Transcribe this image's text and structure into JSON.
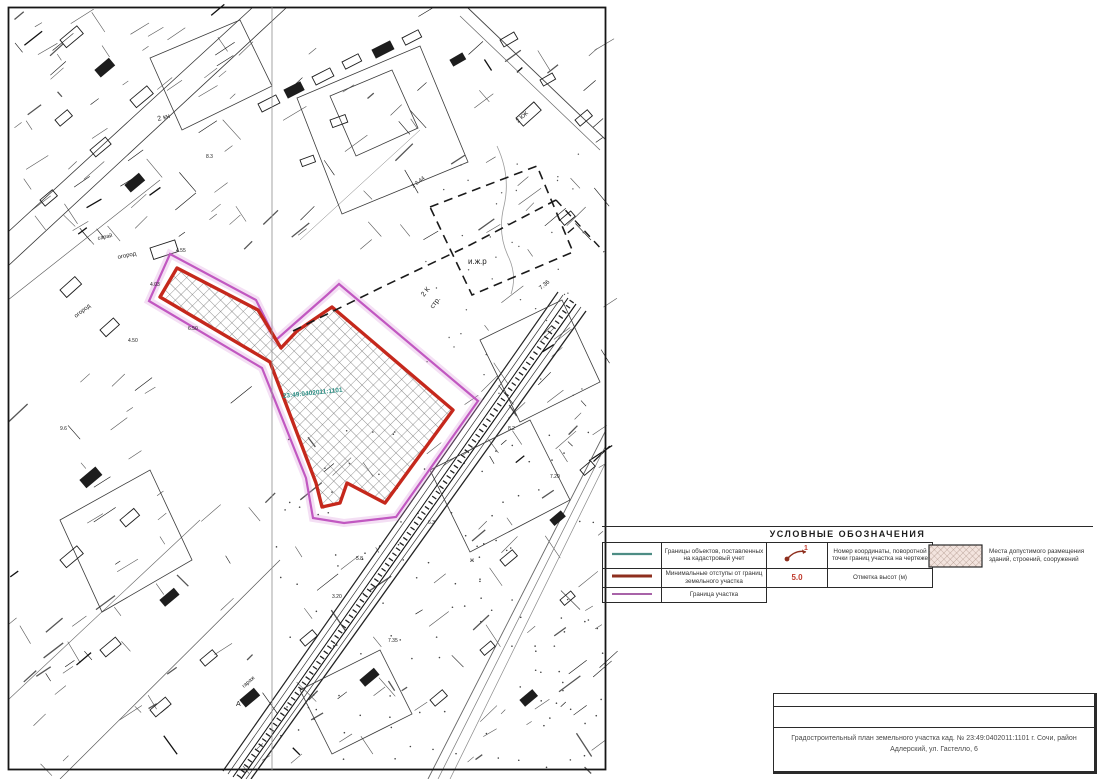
{
  "legend": {
    "title": "УСЛОВНЫЕ ОБОЗНАЧЕНИЯ",
    "rows": [
      {
        "name": "cadastre-boundary-line",
        "color": "#4d8d84",
        "sw": "2.2",
        "label": "Границы объектов, поставленных на кадастровый учет"
      },
      {
        "name": "min-setback-line",
        "color": "#8e2f1e",
        "sw": "3",
        "label": "Минимальные отступы от границ земельного участка"
      },
      {
        "name": "parcel-boundary-line",
        "color": "#a863a8",
        "sw": "2",
        "label": "Граница участка"
      }
    ],
    "symbol_rows": [
      {
        "symbol_text": "1",
        "label": "Номер координаты, поворотной точки границ участка на чертеже"
      },
      {
        "symbol_text": "5.0",
        "label": "Отметка высот (м)"
      }
    ],
    "hatch_item": {
      "label": "Места допустимого размещения зданий, строений, сооружений"
    }
  },
  "title_block": {
    "line1": "Градостроительный план земельного участка кад. № 23:49:0402011:1101 г. Сочи, район",
    "line2": "Адлерский, ул. Гастелло, 6"
  },
  "map": {
    "colors": {
      "red": "#c5281c",
      "magenta": "#c158c1",
      "hatch": "#6a6a6a",
      "teal": "#2e9086"
    },
    "red_polygon_points": "177,268 258,310 281,348 297,331 332,307 453,410 385,503 347,483 340,503 322,507 316,483 270,362 160,297",
    "magenta_polygon_points": "170,254 256,300 276,340 294,324 327,295 339,284 478,401 396,517 344,523 313,518 306,478 262,368 149,301",
    "dashed_parcel_points": "430,207 537,166 573,252 472,295",
    "dashed_line_points": "293,331 380,288 470,245 556,200",
    "dashed_line2_points": "556,200 604,252",
    "stream_d": "M497,146 q14,30 7,60 q-7,28 5,52 q8,18 2,36",
    "cadastral_label": {
      "text": "23:49:0402011:1101",
      "x": 283,
      "y": 398,
      "rot": -6,
      "size": 6.5
    },
    "labels": [
      {
        "t": "2 кн",
        "x": 158,
        "y": 121,
        "r": -15,
        "s": 7
      },
      {
        "t": "8.3",
        "x": 206,
        "y": 158,
        "r": 0,
        "s": 5
      },
      {
        "t": "сарай",
        "x": 98,
        "y": 240,
        "r": -12,
        "s": 5.5
      },
      {
        "t": "огород",
        "x": 118,
        "y": 259,
        "r": -12,
        "s": 6
      },
      {
        "t": "огород",
        "x": 76,
        "y": 318,
        "r": -38,
        "s": 6
      },
      {
        "t": "4.03",
        "x": 150,
        "y": 286,
        "r": 0,
        "s": 5
      },
      {
        "t": "4.55",
        "x": 176,
        "y": 252,
        "r": 0,
        "s": 5
      },
      {
        "t": "4.50",
        "x": 128,
        "y": 342,
        "r": 0,
        "s": 5
      },
      {
        "t": "6.50",
        "x": 188,
        "y": 330,
        "r": 0,
        "s": 5
      },
      {
        "t": "и.ж.р",
        "x": 468,
        "y": 264,
        "r": 0,
        "s": 8
      },
      {
        "t": "2 К",
        "x": 424,
        "y": 297,
        "r": -52,
        "s": 7
      },
      {
        "t": "стр.",
        "x": 433,
        "y": 309,
        "r": -52,
        "s": 7
      },
      {
        "t": "7.36",
        "x": 541,
        "y": 290,
        "r": -40,
        "s": 6
      },
      {
        "t": "1 2.44",
        "x": 413,
        "y": 188,
        "r": -38,
        "s": 5.5
      },
      {
        "t": "2 КЖ",
        "x": 518,
        "y": 123,
        "r": -42,
        "s": 6
      },
      {
        "t": "7.35",
        "x": 388,
        "y": 642,
        "r": 0,
        "s": 5
      },
      {
        "t": "гараж",
        "x": 244,
        "y": 688,
        "r": -42,
        "s": 5.5
      },
      {
        "t": "3.20",
        "x": 332,
        "y": 598,
        "r": 0,
        "s": 5
      },
      {
        "t": "6.3",
        "x": 428,
        "y": 524,
        "r": 0,
        "s": 5
      },
      {
        "t": "7.20",
        "x": 550,
        "y": 478,
        "r": 0,
        "s": 5
      },
      {
        "t": "5.8",
        "x": 356,
        "y": 560,
        "r": 0,
        "s": 5
      },
      {
        "t": "ж",
        "x": 470,
        "y": 562,
        "r": 0,
        "s": 6
      },
      {
        "t": "А",
        "x": 236,
        "y": 706,
        "r": 0,
        "s": 7
      },
      {
        "t": "8.2",
        "x": 508,
        "y": 430,
        "r": 0,
        "s": 5
      },
      {
        "t": "9.6",
        "x": 60,
        "y": 430,
        "r": 0,
        "s": 5
      }
    ],
    "roads": [
      {
        "x1": 558,
        "y1": 292,
        "x2": 223,
        "y2": 771,
        "w": 1.2,
        "c": "#222"
      },
      {
        "x1": 563,
        "y1": 295,
        "x2": 228,
        "y2": 774,
        "w": 0.7,
        "c": "#333"
      },
      {
        "x1": 568,
        "y1": 298,
        "x2": 233,
        "y2": 777,
        "w": 1,
        "c": "#111"
      },
      {
        "x1": 572,
        "y1": 301,
        "x2": 237,
        "y2": 779,
        "w": 5,
        "c": "#222",
        "dash": "1.3 5"
      },
      {
        "x1": 576,
        "y1": 304,
        "x2": 241,
        "y2": 779,
        "w": 1.1,
        "c": "#111"
      },
      {
        "x1": 581,
        "y1": 307,
        "x2": 246,
        "y2": 779,
        "w": 0.7,
        "c": "#333"
      },
      {
        "x1": 586,
        "y1": 311,
        "x2": 251,
        "y2": 779,
        "w": 1.3,
        "c": "#222"
      },
      {
        "x1": 606,
        "y1": 430,
        "x2": 428,
        "y2": 779,
        "w": 0.9,
        "c": "#666"
      },
      {
        "x1": 606,
        "y1": 445,
        "x2": 438,
        "y2": 779,
        "w": 0.7,
        "c": "#777"
      },
      {
        "x1": 606,
        "y1": 462,
        "x2": 450,
        "y2": 779,
        "w": 0.7,
        "c": "#888"
      },
      {
        "x1": 468,
        "y1": 8,
        "x2": 606,
        "y2": 140,
        "w": 0.9,
        "c": "#444"
      },
      {
        "x1": 460,
        "y1": 16,
        "x2": 600,
        "y2": 150,
        "w": 0.7,
        "c": "#666"
      },
      {
        "x1": 8,
        "y1": 232,
        "x2": 252,
        "y2": 8,
        "w": 0.8,
        "c": "#333"
      },
      {
        "x1": 8,
        "y1": 266,
        "x2": 286,
        "y2": 8,
        "w": 0.8,
        "c": "#333"
      },
      {
        "x1": 8,
        "y1": 300,
        "x2": 160,
        "y2": 180,
        "w": 0.6,
        "c": "#555"
      },
      {
        "x1": 60,
        "y1": 779,
        "x2": 280,
        "y2": 560,
        "w": 0.7,
        "c": "#555"
      },
      {
        "x1": 8,
        "y1": 700,
        "x2": 200,
        "y2": 520,
        "w": 0.6,
        "c": "#666"
      },
      {
        "x1": 300,
        "y1": 240,
        "x2": 420,
        "y2": 130,
        "w": 0.5,
        "c": "#777"
      }
    ],
    "parcels": [
      {
        "points": "297,98 420,46 468,162 342,214"
      },
      {
        "points": "150,58 240,20 272,86 182,130"
      },
      {
        "points": "60,520 150,470 192,560 102,612"
      },
      {
        "points": "480,340 562,300 600,382 520,422"
      },
      {
        "points": "330,96 392,70 418,128 356,156"
      },
      {
        "points": "430,470 530,420 570,500 470,552"
      },
      {
        "points": "300,690 380,650 412,714 332,754"
      }
    ]
  }
}
